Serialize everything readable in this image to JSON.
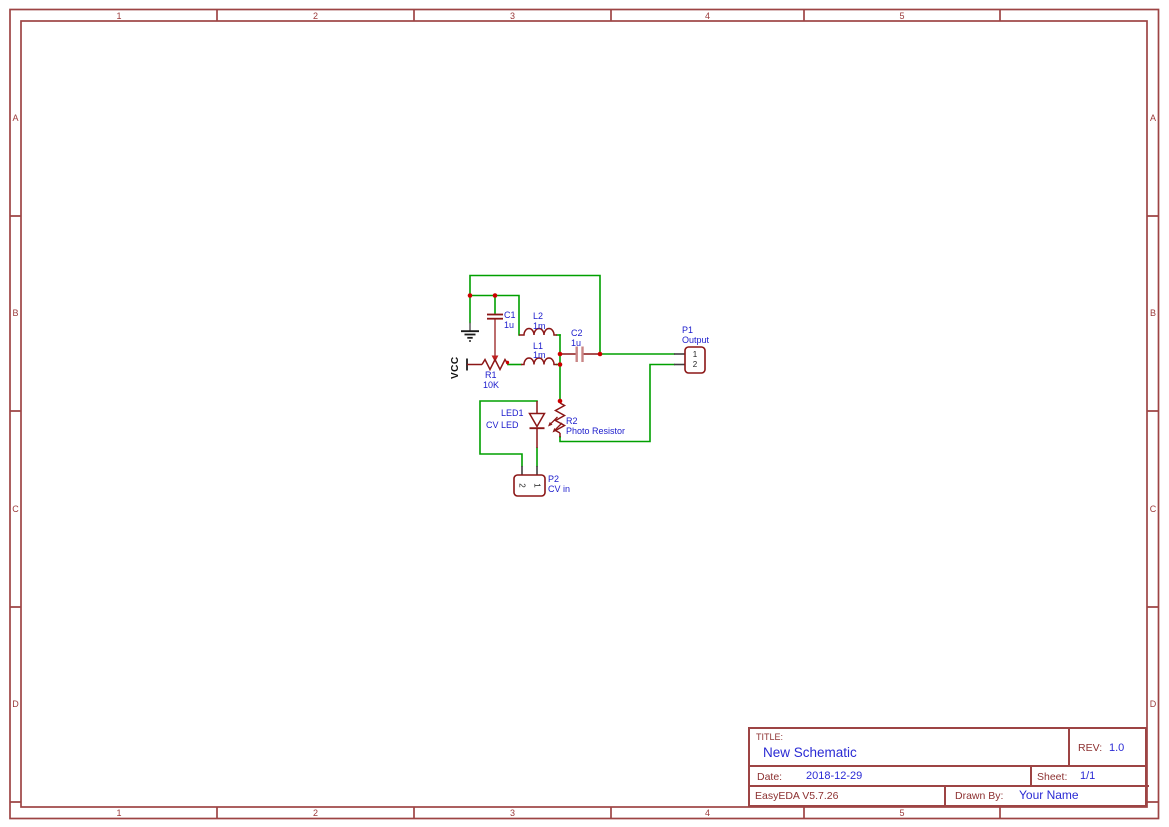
{
  "frame": {
    "columns": [
      "1",
      "2",
      "3",
      "4",
      "5"
    ],
    "rows": [
      "A",
      "B",
      "C",
      "D"
    ]
  },
  "title_block": {
    "title_label": "TITLE:",
    "title": "New Schematic",
    "rev_label": "REV:",
    "rev": "1.0",
    "date_label": "Date:",
    "date": "2018-12-29",
    "sheet_label": "Sheet:",
    "sheet": "1/1",
    "software": "EasyEDA V5.7.26",
    "drawn_by_label": "Drawn By:",
    "drawn_by": "Your Name"
  },
  "schematic": {
    "net_flags": {
      "vcc": "VCC"
    },
    "components": {
      "c1": {
        "ref": "C1",
        "value": "1u"
      },
      "c2": {
        "ref": "C2",
        "value": "1u"
      },
      "l1": {
        "ref": "L1",
        "value": "1m"
      },
      "l2": {
        "ref": "L2",
        "value": "1m"
      },
      "r1": {
        "ref": "R1",
        "value": "10K"
      },
      "r2": {
        "ref": "R2",
        "value": "Photo Resistor"
      },
      "led1": {
        "ref": "LED1",
        "value": "CV LED"
      },
      "p1": {
        "ref": "P1",
        "value": "Output",
        "pins": [
          "1",
          "2"
        ]
      },
      "p2": {
        "ref": "P2",
        "value": "CV in",
        "pins": [
          "2",
          "1"
        ]
      }
    },
    "colors": {
      "wire": "#00A000",
      "component": "#8B1616",
      "junction": "#CC0000",
      "label": "#1B1BCC",
      "frame": "#9D4444"
    }
  }
}
